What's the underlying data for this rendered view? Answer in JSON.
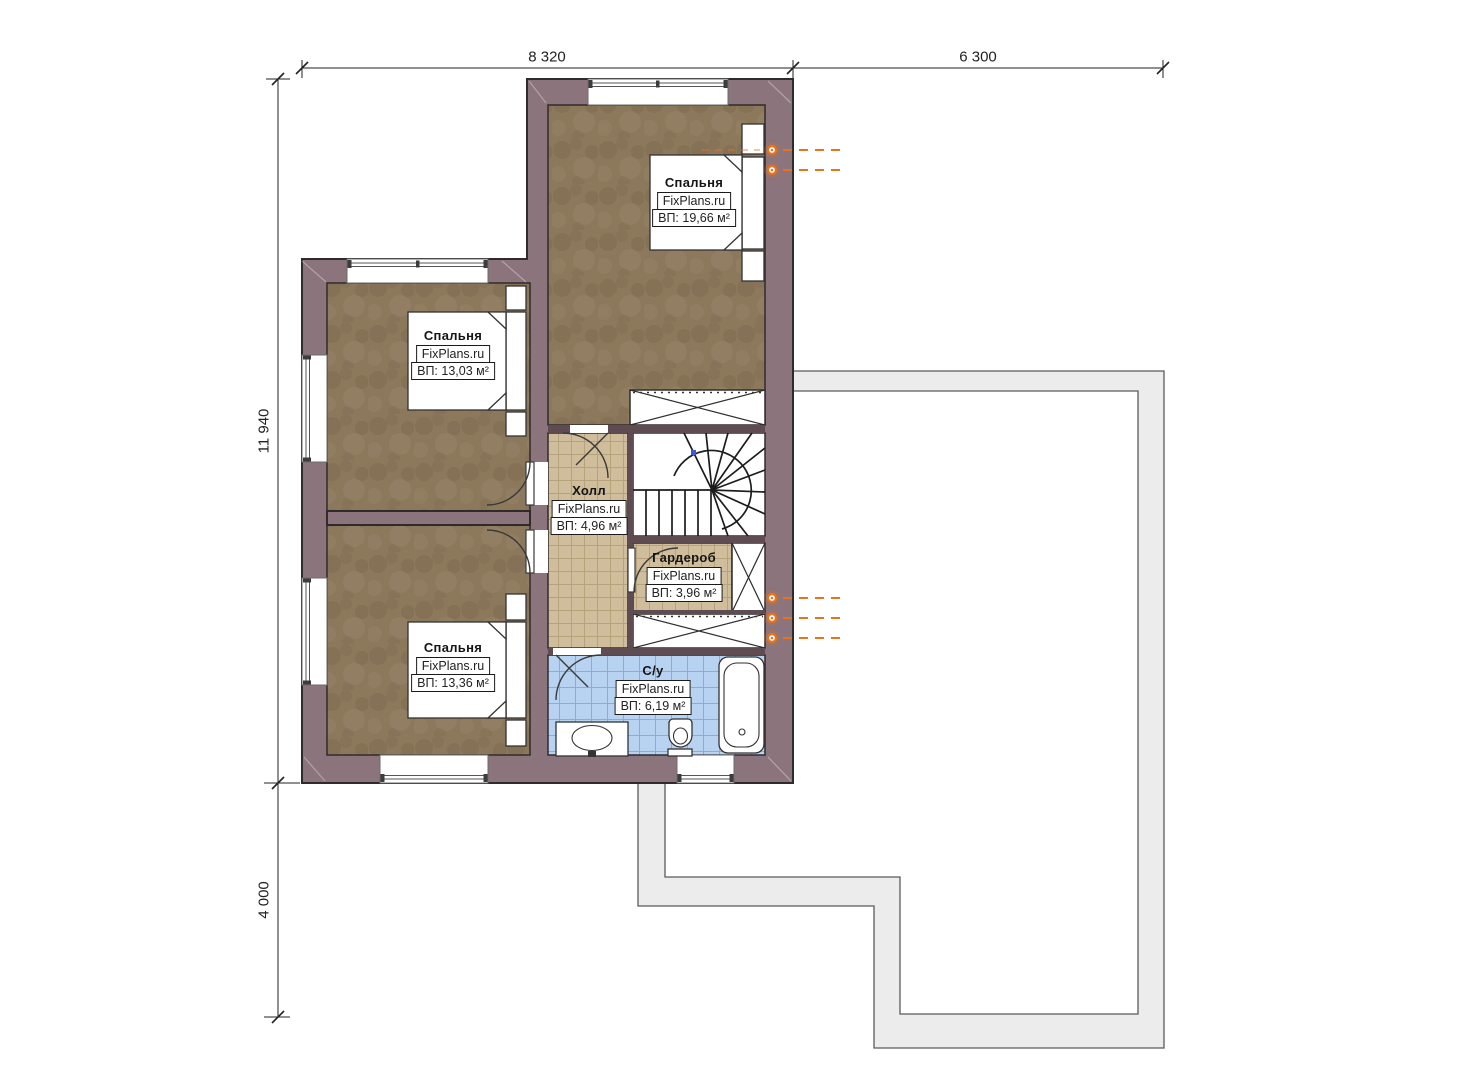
{
  "plan": {
    "rooms": [
      {
        "key": "bedroom_top",
        "name": "Спальня",
        "brand": "FixPlans.ru",
        "area": "ВП: 19,66 м²"
      },
      {
        "key": "bedroom_left_top",
        "name": "Спальня",
        "brand": "FixPlans.ru",
        "area": "ВП: 13,03 м²"
      },
      {
        "key": "bedroom_left_bottom",
        "name": "Спальня",
        "brand": "FixPlans.ru",
        "area": "ВП: 13,36 м²"
      },
      {
        "key": "hall",
        "name": "Холл",
        "brand": "FixPlans.ru",
        "area": "ВП: 4,96 м²"
      },
      {
        "key": "wardrobe",
        "name": "Гардероб",
        "brand": "FixPlans.ru",
        "area": "ВП: 3,96 м²"
      },
      {
        "key": "bathroom",
        "name": "С/у",
        "brand": "FixPlans.ru",
        "area": "ВП: 6,19 м²"
      }
    ],
    "dimensions": {
      "top_left_mm": "8 320",
      "top_right_mm": "6 300",
      "left_upper_mm": "11 940",
      "left_lower_mm": "4 000"
    },
    "colors": {
      "wall": "#8b747b",
      "wall_dark": "#5f4b52",
      "outline": "#2f2b2d",
      "carpet": "#8c785b",
      "tile_beige": "#cfbd9c",
      "tile_beige_line": "#a28c60",
      "tile_blue": "#b7d3f1",
      "tile_blue_line": "#79a5d9",
      "fixture_orange": "#e8731e",
      "roof_band": "#ececec",
      "roof_line": "#5a5a5a",
      "dim_line": "#222222"
    }
  }
}
